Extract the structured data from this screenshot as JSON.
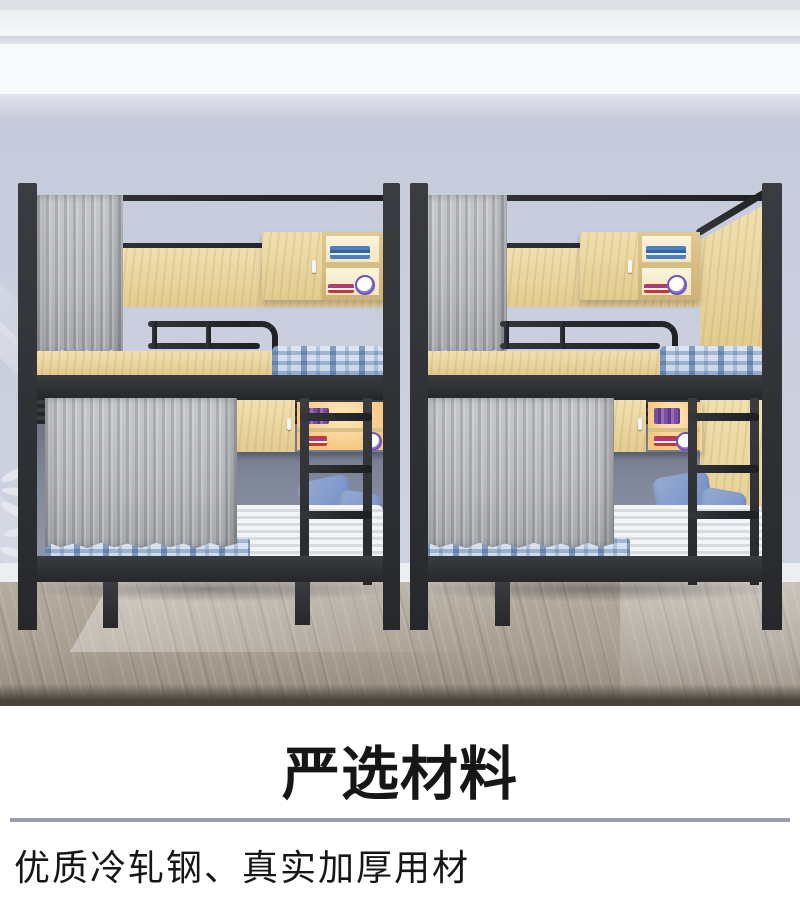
{
  "caption": {
    "title": "严选材料",
    "subtitle": "优质冷轧钢、真实加厚用材"
  },
  "scene": {
    "alt": "Two black steel dormitory bunk beds with gray privacy curtains, wooden wall cabinets, plaid mattresses, blue pillows and side ladders in a room with lavender walls and wood floor",
    "colors": {
      "wall": "#c6cbdc",
      "ceiling": "#f8f9fb",
      "floor": "#a89e91",
      "frame": "#26282b",
      "wood": "#f1e0b0",
      "wood-deep": "#e2cb90",
      "curtain": "#b9bbc0",
      "plaid-blue": "#4d79ad",
      "mattress": "#eef0f3",
      "pillow": "#8099cc",
      "glow": "#f6c57e",
      "interior": "#81889b",
      "baseboard": "#eceef1",
      "divider": "#9b9da8",
      "text": "#161616"
    }
  }
}
